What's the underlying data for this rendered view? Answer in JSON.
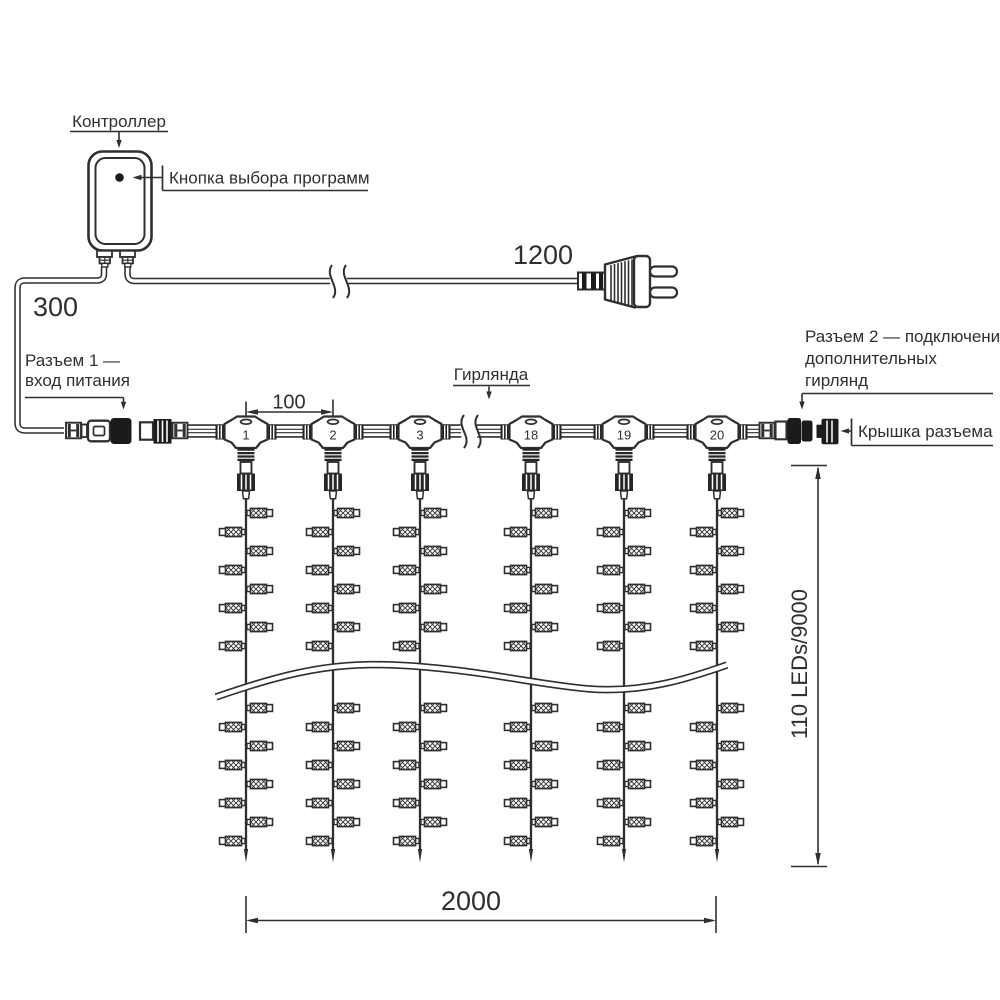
{
  "diagram": {
    "labels": {
      "controller": "Контроллер",
      "program_button": "Кнопка выбора программ",
      "garland": "Гирлянда",
      "connector1_line1": "Разъем 1 —",
      "connector1_line2": "вход питания",
      "connector2_line1": "Разъем 2 — подключение",
      "connector2_line2": "дополнительных",
      "connector2_line3": "гирлянд",
      "connector_cap": "Крышка разъема"
    },
    "dimensions": {
      "plug_cable": "1200",
      "input_cable": "300",
      "drop_spacing": "100",
      "curtain_width": "2000",
      "curtain_height": "110 LEDs/9000"
    },
    "drop_numbers": [
      "1",
      "2",
      "3",
      "18",
      "19",
      "20"
    ],
    "colors": {
      "line": "#2f2f2f",
      "dark_fill": "#1b1b1b",
      "background": "#ffffff"
    }
  }
}
